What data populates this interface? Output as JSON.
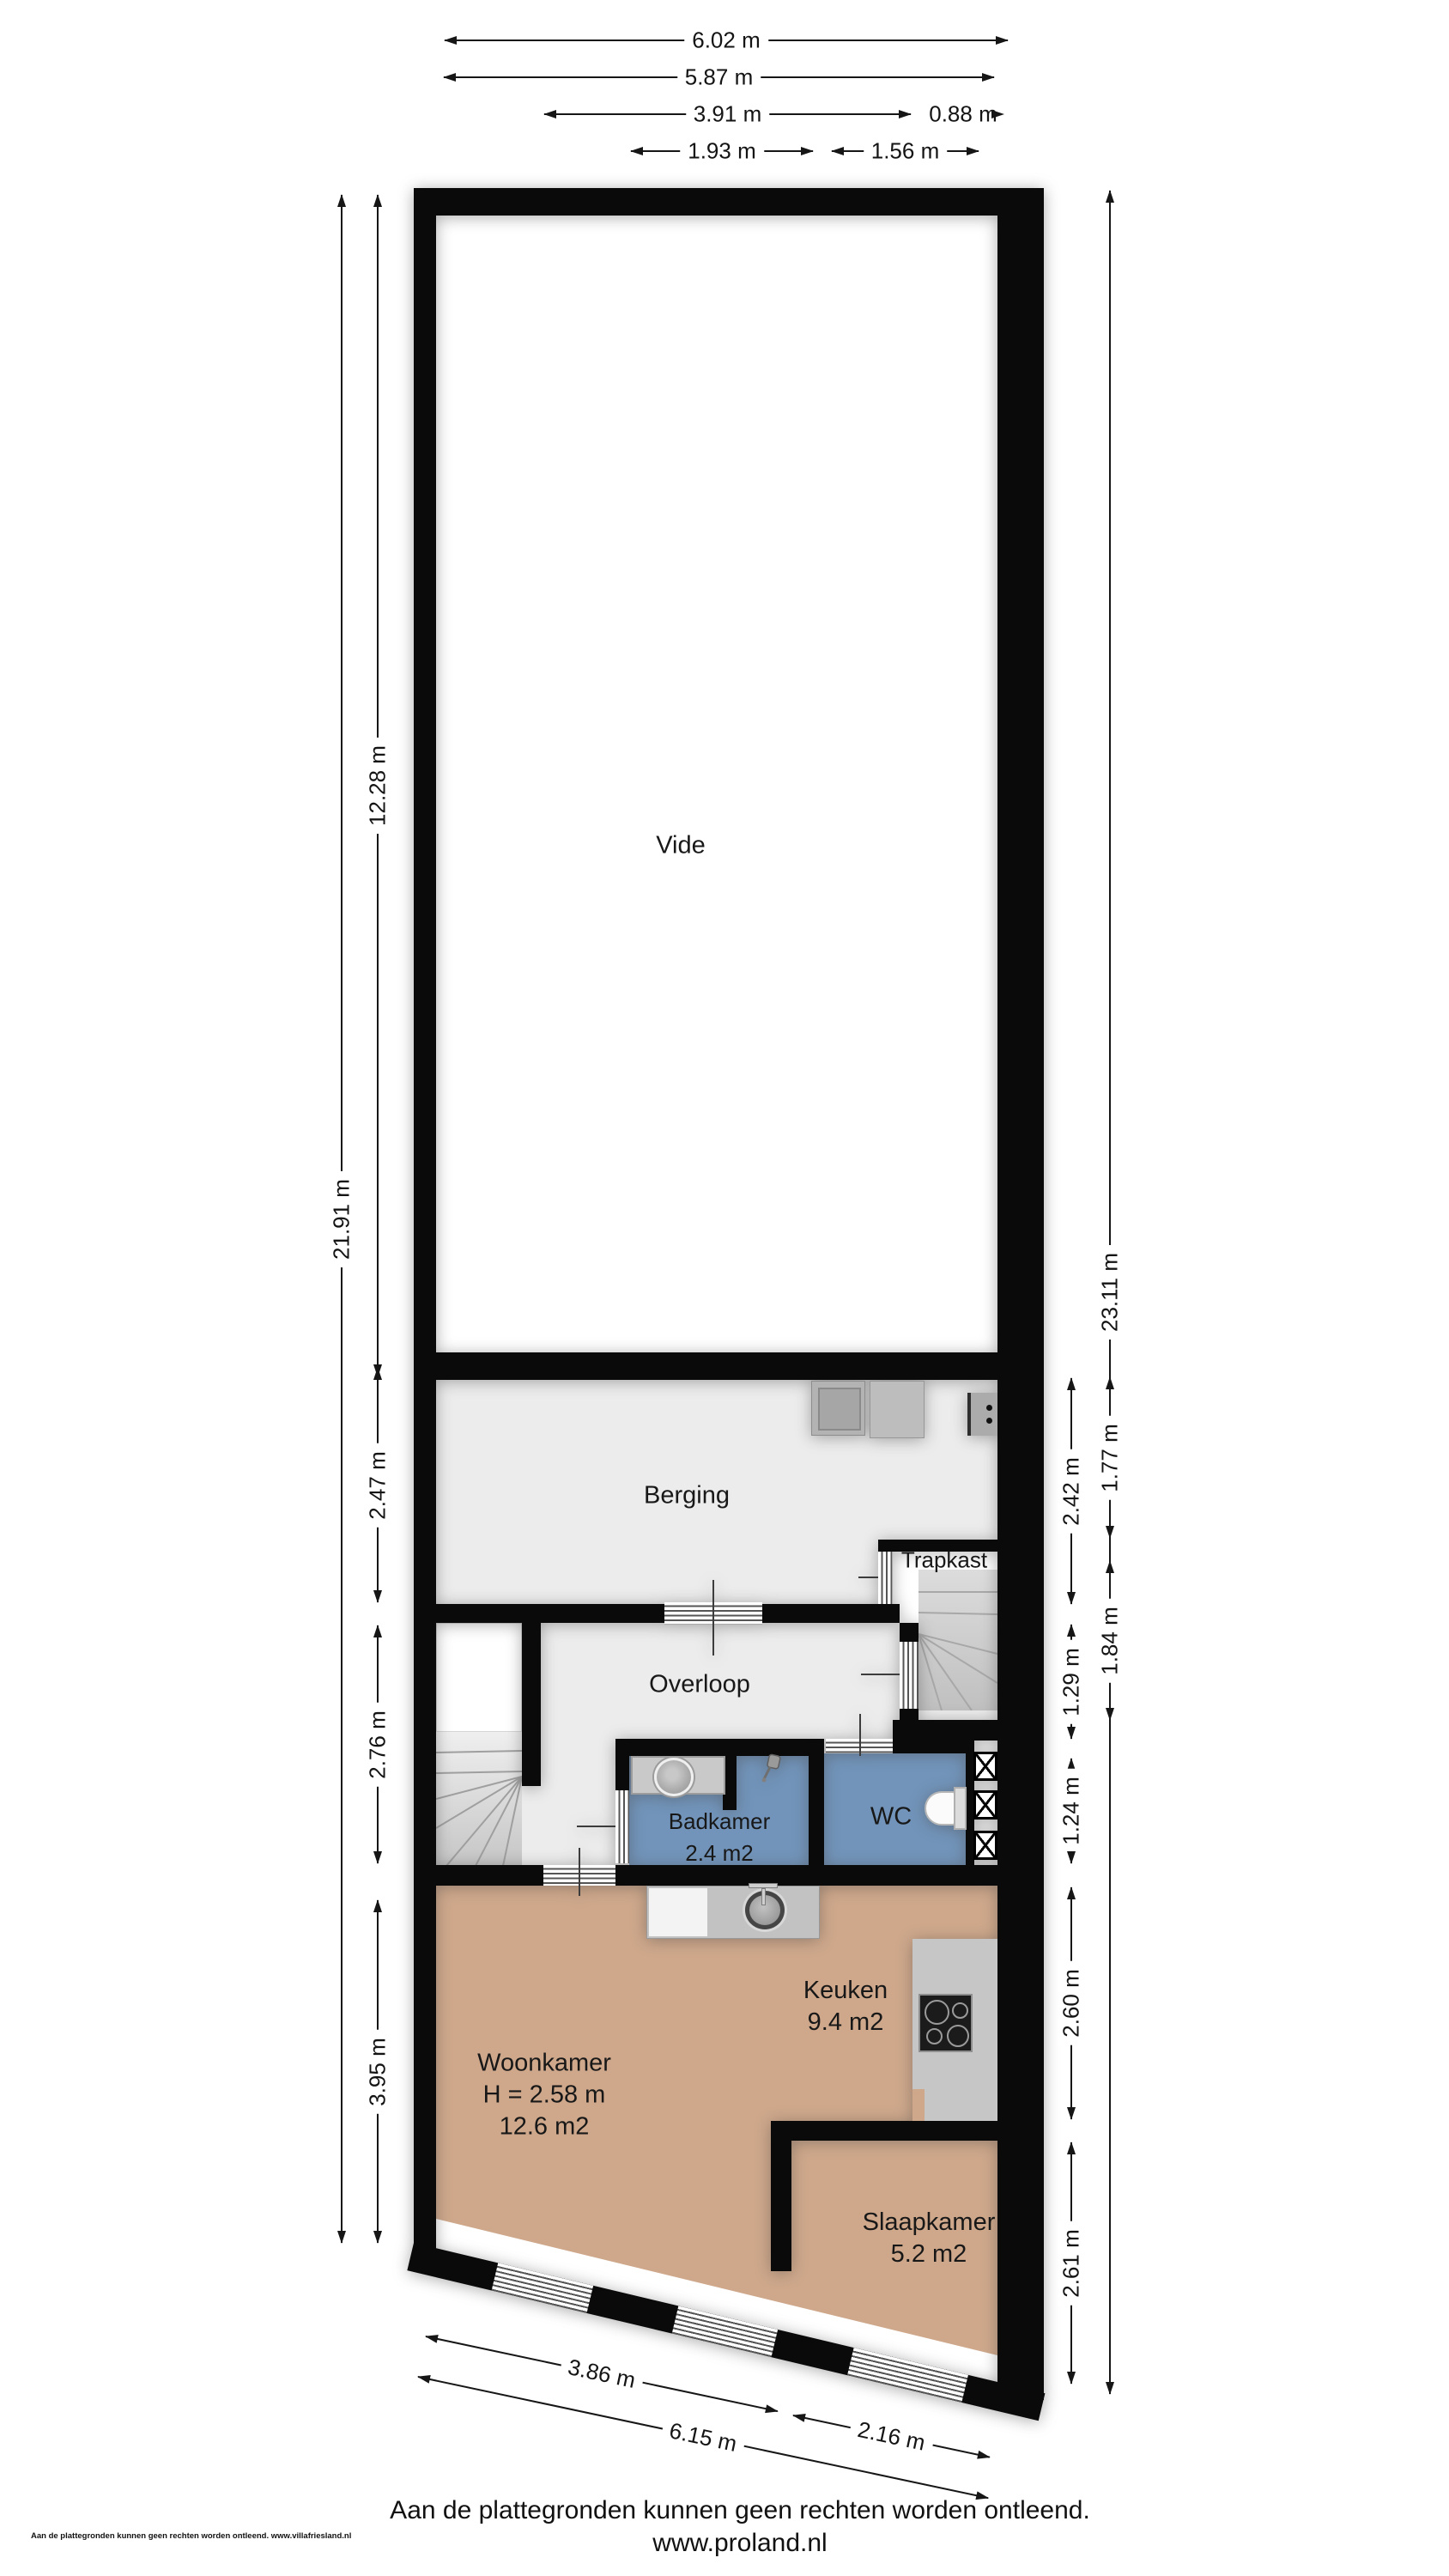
{
  "plan_title": "floorplan",
  "rooms": {
    "vide": {
      "name": "Vide"
    },
    "berging": {
      "name": "Berging"
    },
    "trapkast": {
      "name": "Trapkast"
    },
    "overloop": {
      "name": "Overloop"
    },
    "badkamer": {
      "name": "Badkamer",
      "area": "2.4 m2"
    },
    "wc": {
      "name": "WC"
    },
    "keuken": {
      "name": "Keuken",
      "area": "9.4 m2"
    },
    "woonkamer": {
      "name": "Woonkamer",
      "ceiling_height": "H = 2.58 m",
      "area": "12.6 m2"
    },
    "slaapkamer": {
      "name": "Slaapkamer",
      "area": "5.2 m2"
    }
  },
  "dimensions": {
    "top": [
      "6.02 m",
      "5.87 m",
      "3.91 m",
      "0.88 m",
      "1.93 m",
      "1.56 m"
    ],
    "left": [
      "21.91 m",
      "12.28 m",
      "2.47 m",
      "2.76 m",
      "3.95 m"
    ],
    "right": [
      "23.11 m",
      "2.42 m",
      "1.29 m",
      "1.24 m",
      "2.60 m",
      "2.61 m",
      "1.77 m",
      "1.84 m"
    ],
    "bottom": [
      "3.86 m",
      "6.15 m",
      "2.16 m"
    ]
  },
  "footer": {
    "disclaimer": "Aan de plattegronden kunnen geen rechten worden ontleend.",
    "website": "www.proland.nl",
    "small_print": "Aan de plattegronden kunnen geen rechten worden ontleend. www.villafriesland.nl"
  },
  "colors": {
    "wall": "#0a0a0a",
    "floor_light_gray": "#ececec",
    "floor_tan": "#cfa88b",
    "wet_room_blue": "#7294ba",
    "counter_gray": "#c6c6c6",
    "stair_gray": "#d2d2d2"
  }
}
